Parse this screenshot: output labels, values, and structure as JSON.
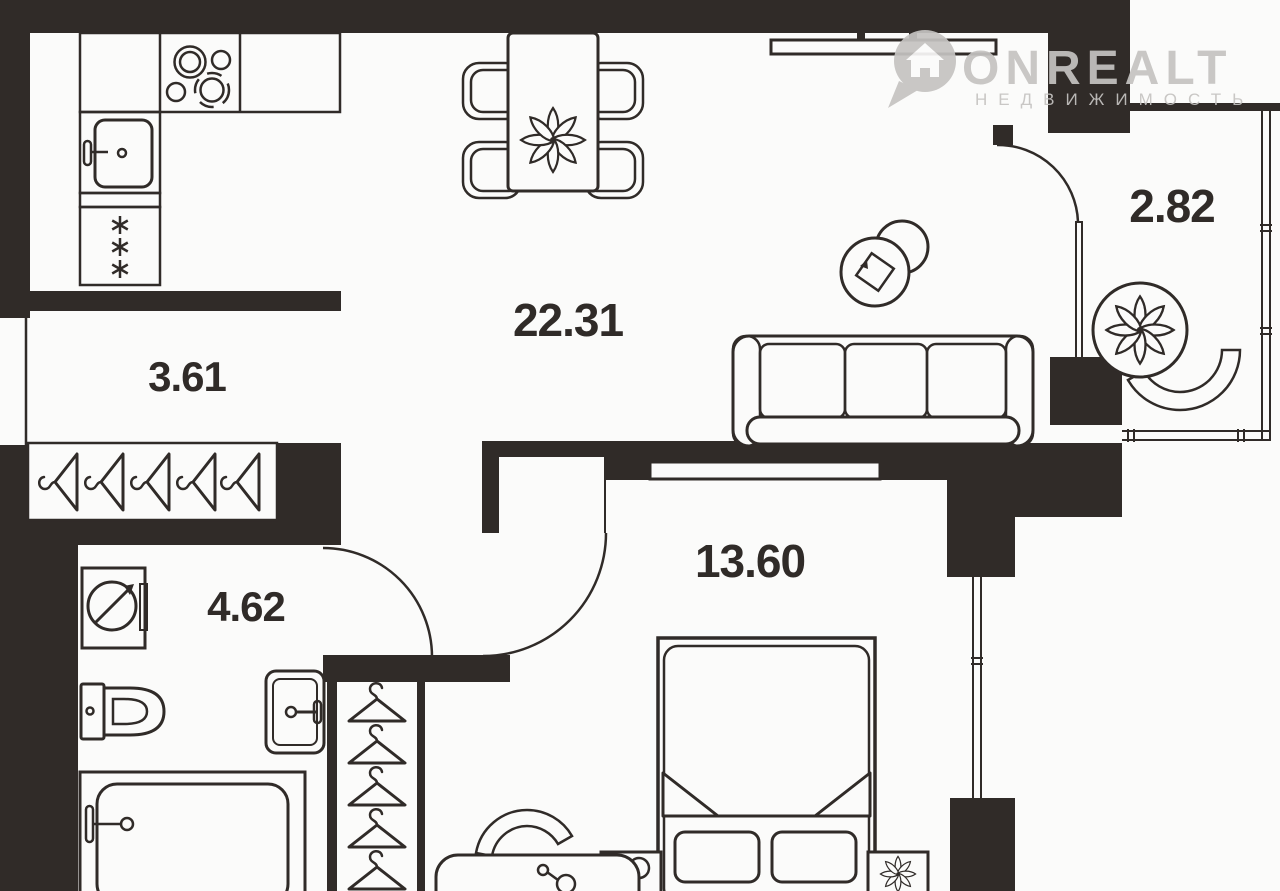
{
  "watermark": {
    "brand": "ONREALT",
    "subtitle": "НЕДВИЖИМОСТЬ"
  },
  "rooms": {
    "living_kitchen": {
      "area": "22.31"
    },
    "hallway": {
      "area": "3.61"
    },
    "bathroom": {
      "area": "4.62"
    },
    "bedroom": {
      "area": "13.60"
    },
    "balcony": {
      "area": "2.82"
    }
  },
  "colors": {
    "wall": "#302b28",
    "line": "#302b28",
    "background": "#fbfbfa",
    "watermark": "#c5c3c1"
  }
}
